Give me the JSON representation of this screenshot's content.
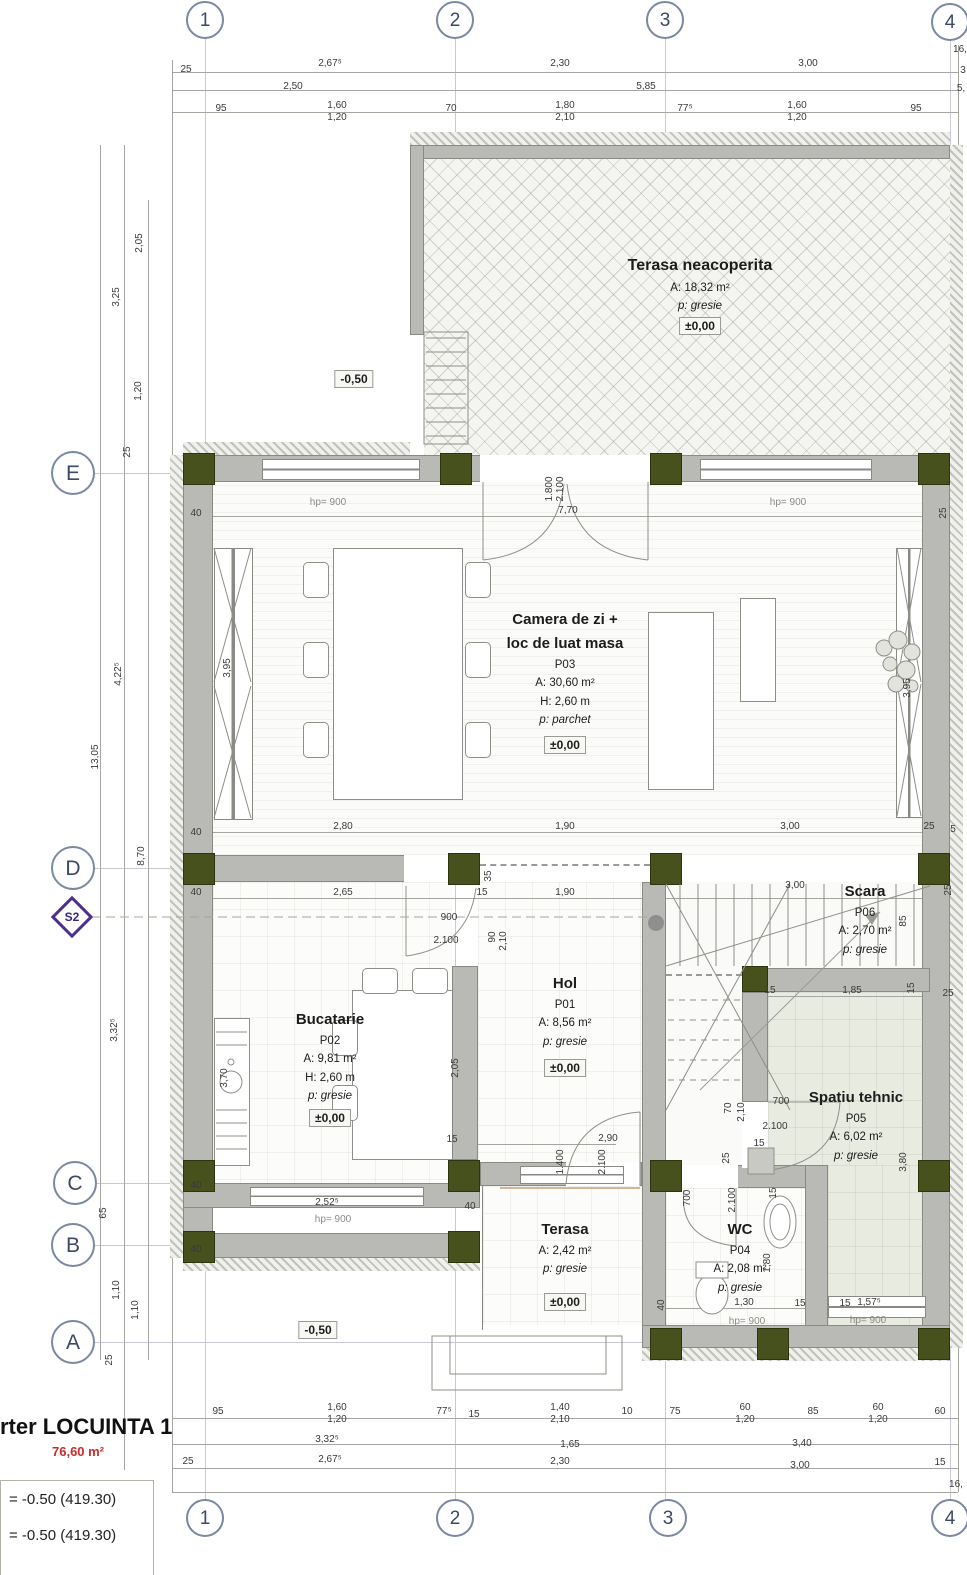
{
  "axes": {
    "cols": [
      "1",
      "2",
      "3",
      "4"
    ],
    "rows": [
      "E",
      "D",
      "C",
      "B",
      "A"
    ],
    "section": "S2"
  },
  "rooms": {
    "terasa_sus": {
      "name": "Terasa neacoperita",
      "area": "A: 18,32 m²",
      "floor": "p: gresie",
      "level": "±0,00"
    },
    "camera": {
      "name1": "Camera de zi +",
      "name2": "loc de luat masa",
      "code": "P03",
      "area": "A: 30,60 m²",
      "height": "H: 2,60 m",
      "floor": "p: parchet",
      "level": "±0,00"
    },
    "bucatarie": {
      "name": "Bucatarie",
      "code": "P02",
      "area": "A: 9,81 m²",
      "height": "H: 2,60 m",
      "floor": "p: gresie",
      "level": "±0,00"
    },
    "hol": {
      "name": "Hol",
      "code": "P01",
      "area": "A: 8,56 m²",
      "floor": "p: gresie",
      "level": "±0,00"
    },
    "scara": {
      "name": "Scara",
      "code": "P06",
      "area": "A: 2,70 m²",
      "floor": "p: gresie"
    },
    "spatiu": {
      "name": "Spatiu tehnic",
      "code": "P05",
      "area": "A: 6,02 m²",
      "floor": "p: gresie"
    },
    "wc": {
      "name": "WC",
      "code": "P04",
      "area": "A: 2,08 m²",
      "floor": "p: gresie"
    },
    "terasa_jos": {
      "name": "Terasa",
      "area": "A: 2,42 m²",
      "floor": "p: gresie",
      "level": "±0,00"
    }
  },
  "levels": {
    "m1": "-0,50",
    "m2": "-0,50"
  },
  "title": {
    "name": "rter LOCUINTA 1",
    "area": "76,60 m²",
    "l1": "= -0.50 (419.30)",
    "l2": "= -0.50 (419.30)"
  },
  "colors": {
    "column": "#46511d",
    "wall": "#b9b9b5",
    "axis": "#7b87a3",
    "section_marker": "#4a2f8f",
    "area_red": "#cc2a2a"
  },
  "dims": {
    "d1": "25",
    "d2": "2,67⁵",
    "d3": "2,30",
    "d4": "3,00",
    "d5": "2,50",
    "d6": "5,85",
    "d7": "95",
    "d8": "1,60",
    "d9": "1,20",
    "d10": "70",
    "d11": "1,80",
    "d12": "2,10",
    "d13": "77⁵",
    "d14": "1,60",
    "d15": "1,20",
    "d16": "95",
    "d17": "16,",
    "d18": "3",
    "d19": "5,",
    "d20": "2,05",
    "d21": "3,25",
    "d22": "1,20",
    "d23": "25",
    "d24": "13,05",
    "d25": "4,22⁵",
    "d26": "8,70",
    "d27": "3,32⁵",
    "d28": "65",
    "d29": "1,10",
    "d30": "1,10",
    "d31": "25",
    "d32": "hp= 900",
    "d33": "hp= 900",
    "d34": "1.800",
    "d35": "2.100",
    "d36": "7,70",
    "d37": "40",
    "d38": "40",
    "d39": "3,95",
    "d40": "3,95",
    "d41": "25",
    "d42": "25",
    "d43": "5",
    "d44": "2,80",
    "d45": "1,90",
    "d46": "3,00",
    "d47": "2,65",
    "d48": "15",
    "d49": "35",
    "d50": "1,90",
    "d51": "3,00",
    "d52": "40",
    "d53": "900",
    "d54": "2.100",
    "d55": "90",
    "d56": "2,10",
    "d57": "25",
    "d58": "85",
    "d59": "15",
    "d60": "1,85",
    "d61": "15",
    "d62": "25",
    "d63": "70",
    "d64": "2,10",
    "d65": "700",
    "d66": "2.100",
    "d67": "15",
    "d68": "25",
    "d69": "3,80",
    "d70": "3,70",
    "d71": "2,05",
    "d72": "15",
    "d73": "2,90",
    "d74": "1.400",
    "d75": "2.100",
    "d76": "2,52⁵",
    "d77": "hp= 900",
    "d78": "40",
    "d79": "40",
    "d80": "40",
    "d81": "700",
    "d82": "2.100",
    "d83": "15",
    "d84": "1,80",
    "d85": "1,30",
    "d86": "hp= 900",
    "d87": "15",
    "d88": "15",
    "d89": "40",
    "d90": "1,57⁵",
    "d91": "hp= 900",
    "d92": "95",
    "d93": "1,60",
    "d94": "1,20",
    "d95": "77⁵",
    "d96": "15",
    "d97": "1,40",
    "d98": "2,10",
    "d99": "10",
    "d100": "75",
    "d101": "60",
    "d102": "1,20",
    "d103": "85",
    "d104": "60",
    "d105": "1,20",
    "d106": "60",
    "d107": "3,32⁵",
    "d108": "1,65",
    "d109": "3,40",
    "d110": "15",
    "d111": "25",
    "d112": "2,67⁵",
    "d113": "2,30",
    "d114": "3,00",
    "d115": "16,"
  }
}
